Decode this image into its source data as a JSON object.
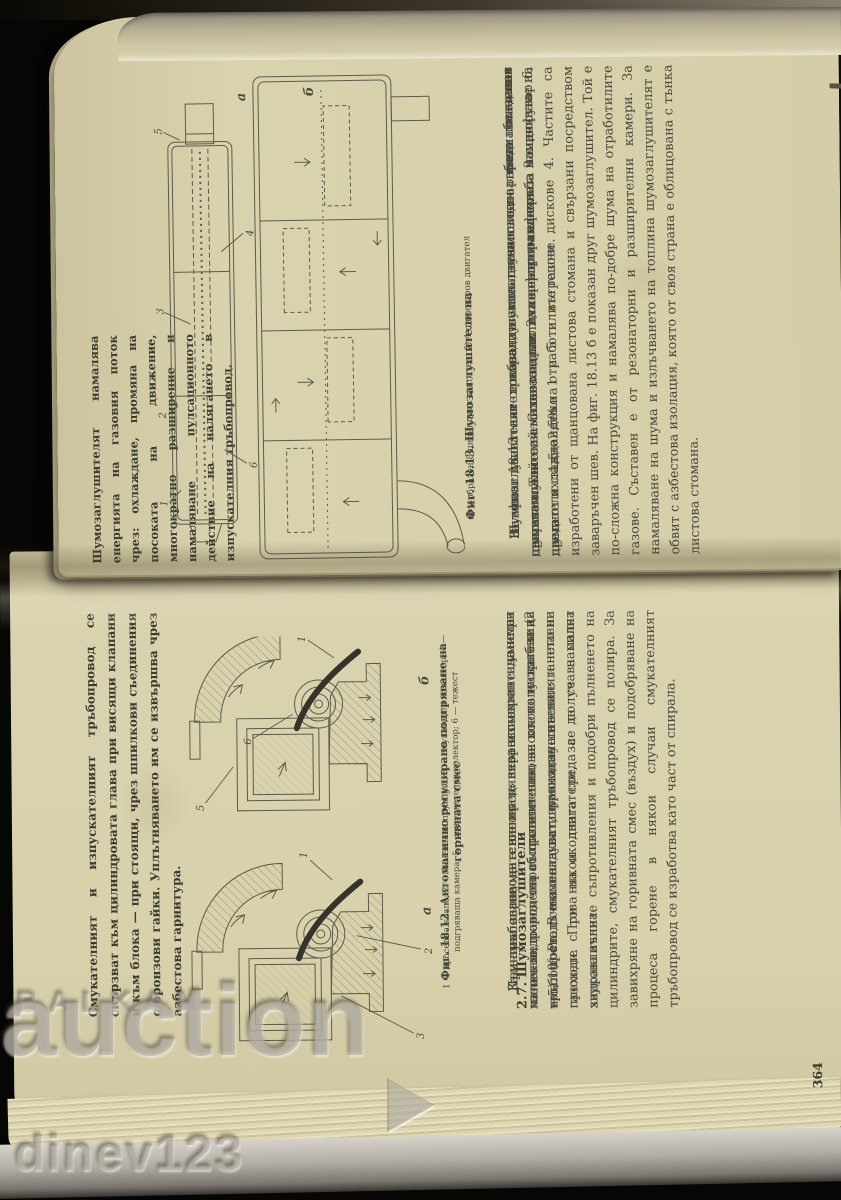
{
  "right_page": {
    "margin_note": "Шумозаглушителят намалява енергията на газовия поток чрез: охлаждане, промяна на посоката на движение, многократно разширение и намаляване пулсационното действие на налягането в изпускателния тръбопровод.",
    "figure": {
      "caption": "Фиг. 18.13. Шумозаглушители на",
      "caption_sub": "а) V-образен 8-цилиндров двигател; б) 4-цилиндров двигател",
      "label_a": "а",
      "label_b": "б",
      "callouts": [
        "1",
        "2",
        "3",
        "4",
        "5",
        "6"
      ]
    },
    "paragraphs": [
      "Шумозаглушителят трябва да изпълнява своето предназначение при възможно най-малко хидравлично съпротивление.",
      "На фиг. 18.13 а е показан шумозаглушител на голям бензинов двигател. Той се състои от тяло 2, перфорирана тръба 3 с дифузор 6, предно и задно дъно 1 и 5 и вътрешни дискове 4. Частите са изработени от щанцована листова стомана и свързани посредством заваръчен шев. На фиг. 18.13 б е показан друг шумозаглушител. Той е по-сложна конструкция и намалява по-добре шума на отработилите газове. Съставен е от резонаторни и разширителни камери. За намаляване на шума и излъчването на топлина шумозаглушителят е обвит с азбестова изолация, която от своя страна е облицована с тънка листова стомана.",
      "За някои двигатели се използуват по два последователно поставени шумозаглушители. С това се постига по-голям ефект за намаляване на шума от охлаждането на отработилите газове.",
      "Шумозаглушителите поради своя начин на работа създават съпротивление за излизащите газове и намаляват мощността на двигателя с 1,5—2,5%."
    ]
  },
  "left_page": {
    "margin_note": "Смукателният и изпускателният тръбопровод се свързват към цилиндровата глава при висящи клапани и към блока — при стоящи, чрез шпилкови съединения с бронзови гайки. Уплътняването им се извършва чрез азбестова гарнитура.",
    "figure": {
      "caption": "Фиг. 18.12. Автоматично регулирано подгряване на горивната смес",
      "legend": "1 — дроселна клапа; 2 — биметална пружина; 3 — смукателен колектор; 4 — подгряваща камера; 5 — изпускателен колектор; 6 — тежест",
      "label_a": "а",
      "label_b": "б",
      "callouts": [
        "1",
        "2",
        "3",
        "5",
        "6"
      ]
    },
    "paragraph_top": "Към тръбопроводите се предявява изискване да имат малко хидравлично съпротивление, за което те трябва да имат достатъчна гладкост, проходно сечение и плавни преходи. При някои двигатели, за да се намалят хидравличните съпротивления и подобри пълненето на цилиндрите, смукателният тръбопровод се полира. За завихряне на горивната смес (въздух) и подобряване на процеса горене в някои случаи смукателният тръбопровод се изработва като част от спирала.",
    "section_heading": "2.7. Шумозаглушители",
    "paragraphs": [
      "За намаляване на силния и неравномерен шум при изтичането на отработилите газове от изпускателния тръбопровод се използуват шумозаглушители.",
      "Причина за шума е високата скорост на изтичане на газовете, породена от сравнително високото налягане (2—5).10⁵ Ра. В момента на изравняване на налягането на газовете с това на околната среда се получава силна звукова вълна."
    ],
    "page_number": "364"
  },
  "watermarks": {
    "site_line1": "BALKAN",
    "site_line2": "auction",
    "seller": "dinev123"
  },
  "colors": {
    "paper": "#d8d1ae",
    "ink": "#46453a"
  }
}
